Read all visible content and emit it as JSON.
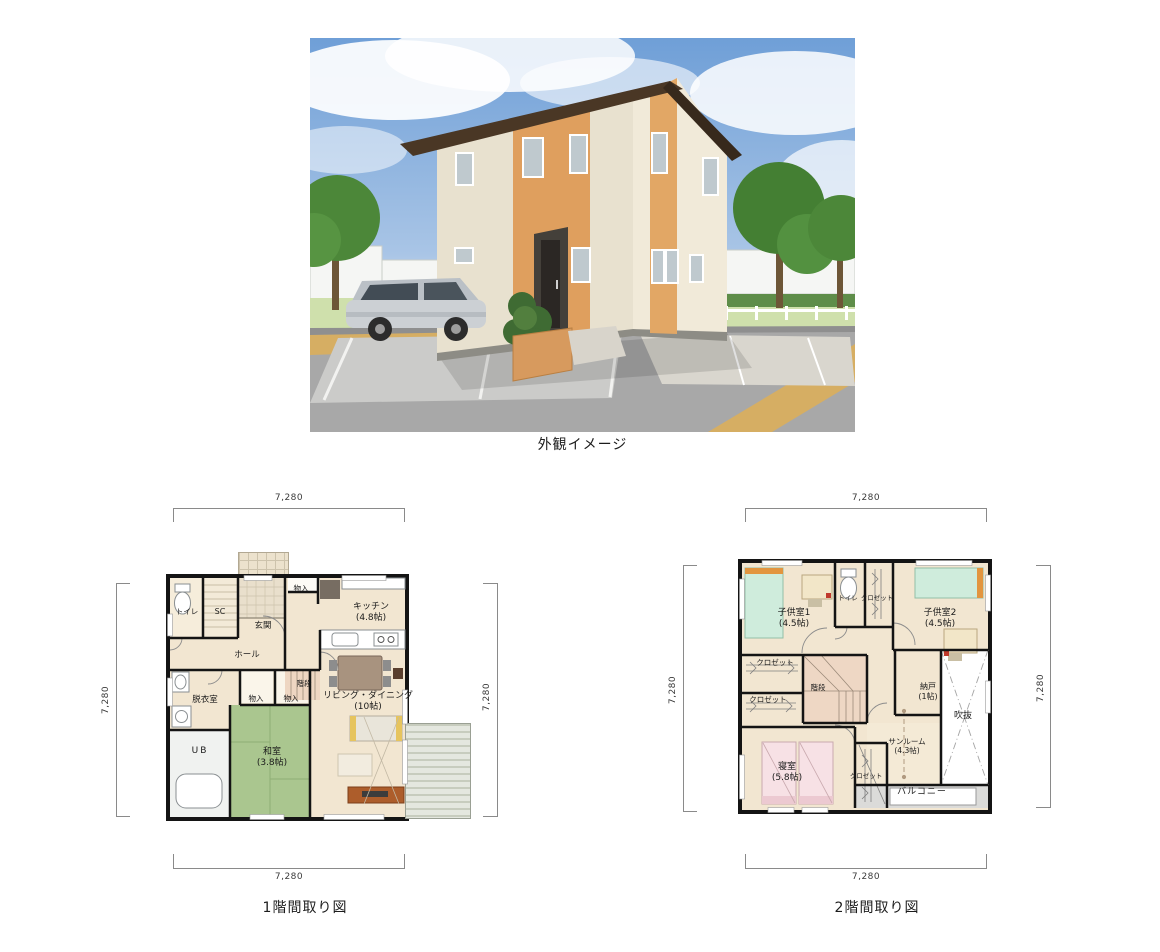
{
  "exterior": {
    "caption": "外観イメージ",
    "palette": {
      "sky": "#6f9fd7",
      "house_wall": "#ebe4d2",
      "brick_accent": "#df9f5e",
      "roof": "#473626",
      "road": "#a8a8a8",
      "curb": "#d6ae63",
      "tree": "#4c8739",
      "car": "#ccd0d4"
    }
  },
  "plan1f": {
    "caption": "1階間取り図",
    "dims": {
      "top": "7,280",
      "bottom": "7,280",
      "left": "7,280",
      "right": "7,280"
    },
    "rooms": [
      {
        "label": "トイレ"
      },
      {
        "label": "SC"
      },
      {
        "label": "玄関"
      },
      {
        "label": "物入"
      },
      {
        "label": "キッチン",
        "size": "(4.8帖)"
      },
      {
        "label": "ホール"
      },
      {
        "label": "階段"
      },
      {
        "label": "脱衣室"
      },
      {
        "label": "物入"
      },
      {
        "label": "物入"
      },
      {
        "label": "リビング・ダイニング",
        "size": "(10帖)"
      },
      {
        "label": "UB"
      },
      {
        "label": "和室",
        "size": "(3.8帖)"
      }
    ],
    "palette": {
      "floor": "#f2e6d1",
      "tatami": "#aac68f",
      "stairs": "#eed6c2",
      "wall": "#141414",
      "deck": "#e4e7df"
    }
  },
  "plan2f": {
    "caption": "2階間取り図",
    "dims": {
      "top": "7,280",
      "bottom": "7,280",
      "left": "7,280",
      "right": "7,280"
    },
    "rooms": [
      {
        "label": "子供室1",
        "size": "(4.5帖)"
      },
      {
        "label": "トイレ"
      },
      {
        "label": "クロゼット"
      },
      {
        "label": "子供室2",
        "size": "(4.5帖)"
      },
      {
        "label": "クロゼット"
      },
      {
        "label": "クロゼット"
      },
      {
        "label": "階段"
      },
      {
        "label": "納戸",
        "size": "(1帖)"
      },
      {
        "label": "吹抜"
      },
      {
        "label": "寝室",
        "size": "(5.8帖)"
      },
      {
        "label": "クロゼット"
      },
      {
        "label": "サンルーム",
        "size": "(4.3帖)"
      },
      {
        "label": "バルコニー"
      }
    ],
    "palette": {
      "bed_green": "#cfecdc",
      "bed_pink": "#f7e1e5",
      "balcony": "#dbdbd9",
      "void": "#ffffff"
    }
  }
}
